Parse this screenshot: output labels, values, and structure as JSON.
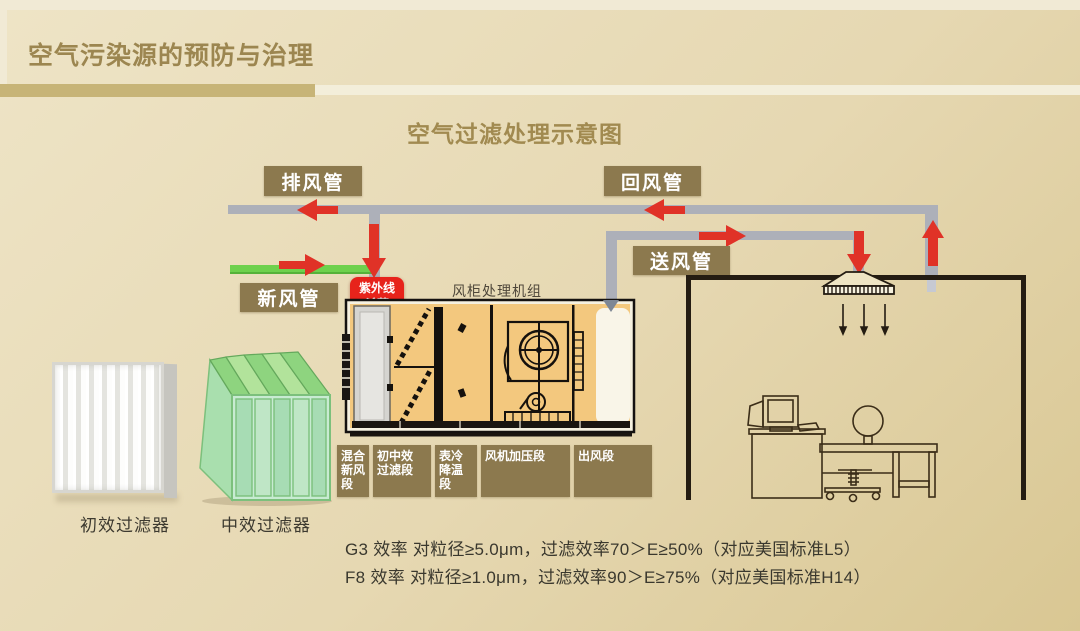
{
  "slide": {
    "title": "空气污染源的预防与治理",
    "subtitle": "空气过滤处理示意图",
    "notes": [
      "G3 效率 对粒径≥5.0μm，过滤效率70＞E≥50%（对应美国标准L5）",
      "F8 效率 对粒径≥1.0μm，过滤效率90＞E≥75%（对应美国标准H14）"
    ]
  },
  "diagram": {
    "ducts": {
      "exhaust": "排风管",
      "return": "回风管",
      "fresh": "新风管",
      "supply": "送风管"
    },
    "uv": "紫外线\n杀菌",
    "ahu_title": "风柜处理机组",
    "sections": [
      "混合\n新风\n段",
      "初中效\n过滤段",
      "表冷\n降温\n段",
      "风机加压段",
      "出风段"
    ],
    "filters": [
      "初效过滤器",
      "中效过滤器"
    ]
  },
  "colors": {
    "title-gold": "#9c8650",
    "bar-gold": "#c7b477",
    "label-brown": "#8c794e",
    "duct-gray": "#adb0b9",
    "fresh-green": "#6ed14d",
    "arrow-red": "#e03227",
    "uv-red": "#e7231b",
    "ahu-tan": "#f3c87e"
  }
}
